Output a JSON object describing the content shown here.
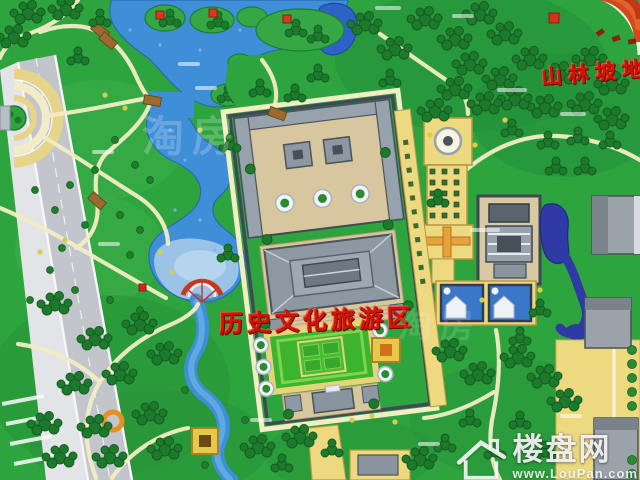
{
  "map": {
    "type": "resort-master-plan-illustration",
    "labels": {
      "mountain_zone": "山林坡地",
      "historic_zone": "历史文化旅游区"
    },
    "label_color": "#d01508",
    "faint_watermark": "淘房",
    "watermark": {
      "brand": "楼盘网",
      "site": "www.LouPan.com",
      "icon": "house-icon"
    },
    "palette": {
      "grass": "#2ea43f",
      "forest": "#1d7a2c",
      "lake": "#3e8ed8",
      "shallow_water": "#9fc6e8",
      "deep_canal": "#2f3aa6",
      "path_cream": "#f3edc4",
      "plaza_yellow": "#ecd980",
      "road_gray": "#c2c6cc",
      "roof_gray": "#8e98a2",
      "wall_dark": "#3e4a56",
      "courtyard_beige": "#d8c79e",
      "accent_red": "#c8381c"
    }
  }
}
